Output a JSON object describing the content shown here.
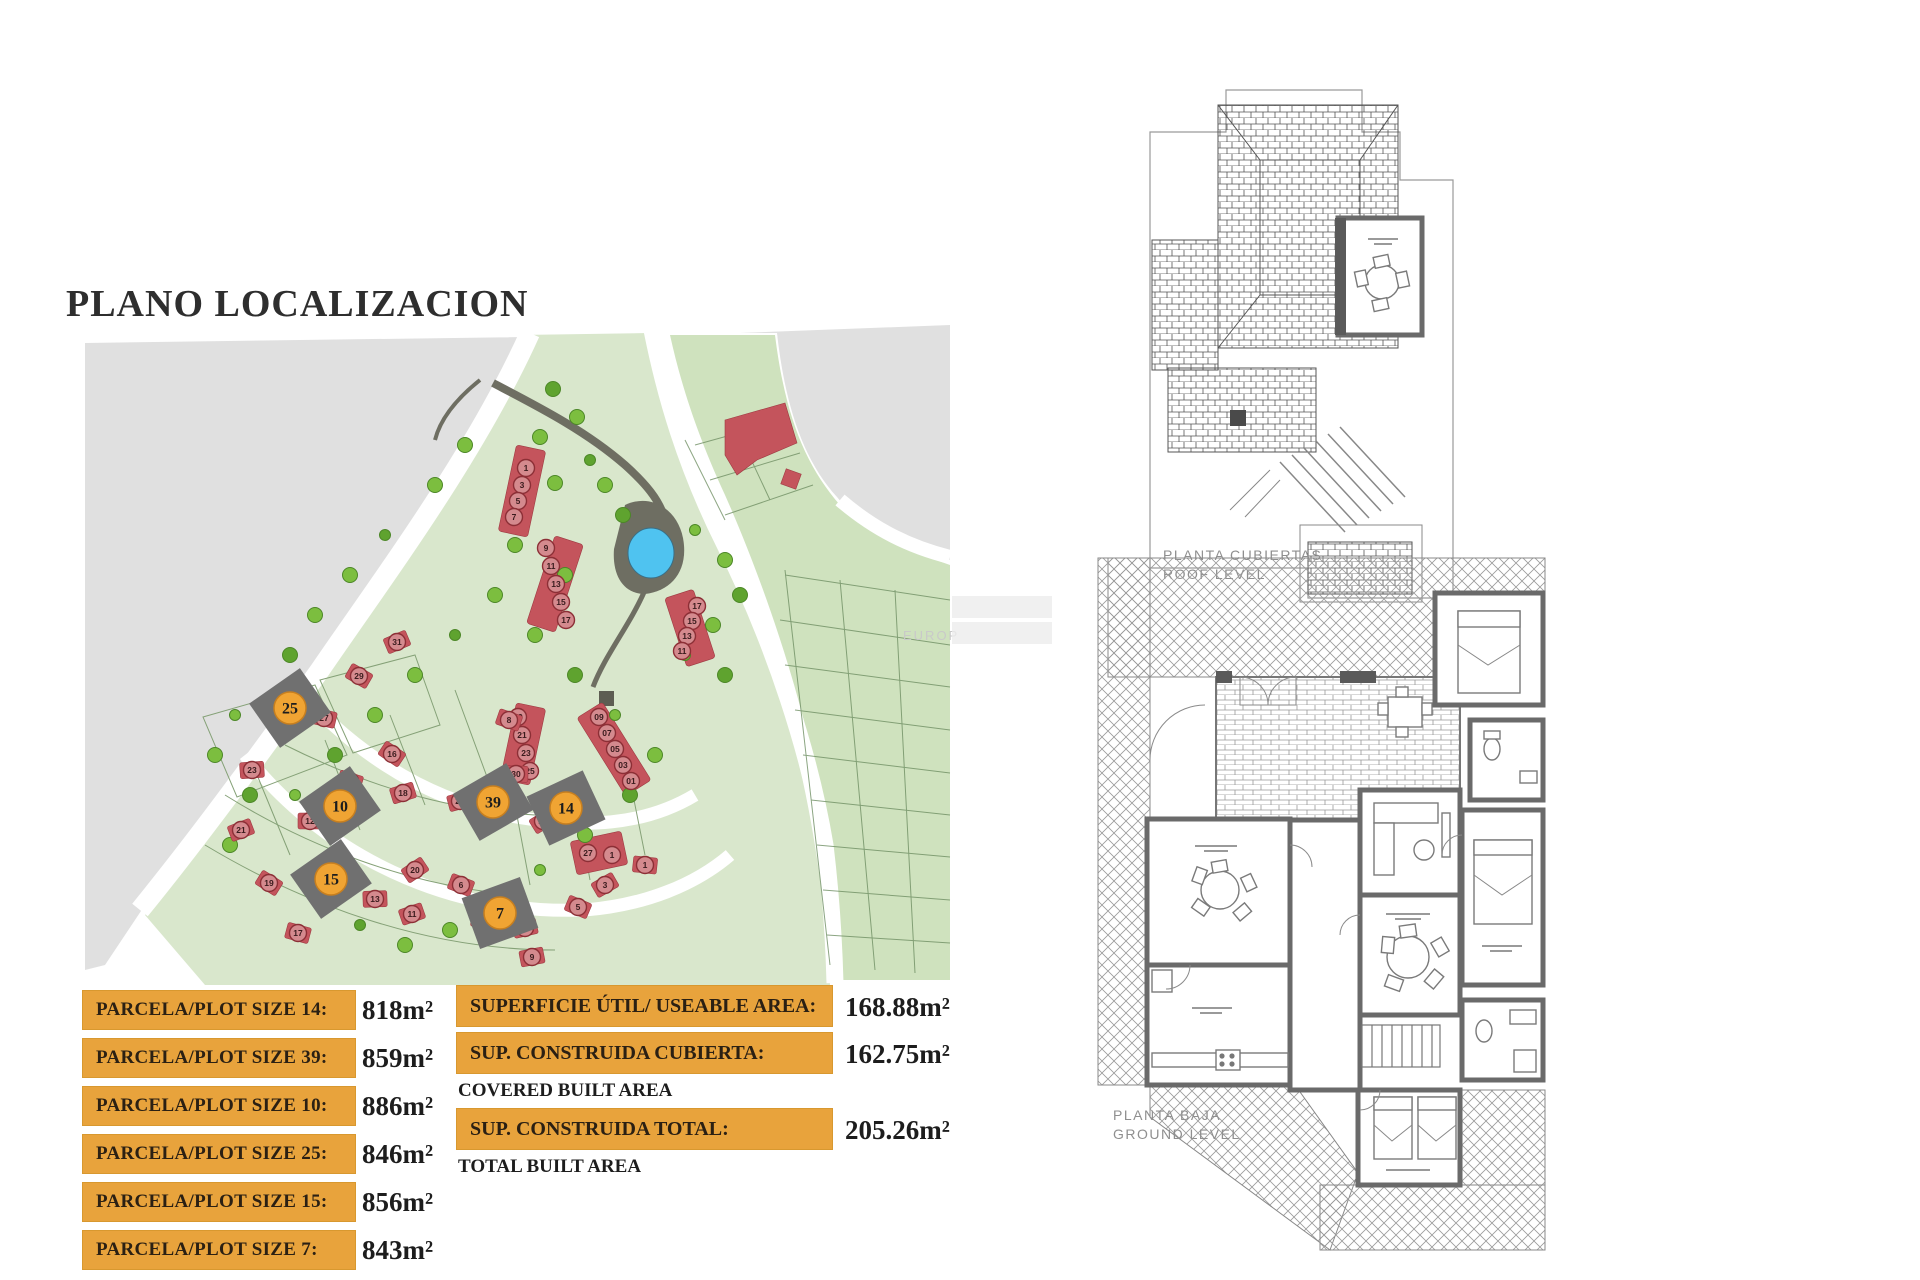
{
  "title": "PLANO LOCALIZACION",
  "watermark": "EUROP",
  "plot_table": {
    "rows": [
      {
        "label": "PARCELA/PLOT SIZE 14:",
        "value": "818m²"
      },
      {
        "label": "PARCELA/PLOT SIZE 39:",
        "value": "859m²"
      },
      {
        "label": "PARCELA/PLOT SIZE 10:",
        "value": "886m²"
      },
      {
        "label": "PARCELA/PLOT SIZE 25:",
        "value": "846m²"
      },
      {
        "label": "PARCELA/PLOT SIZE 15:",
        "value": "856m²"
      },
      {
        "label": "PARCELA/PLOT SIZE 7:",
        "value": "843m²"
      }
    ]
  },
  "area_table": {
    "rows": [
      {
        "label": "SUPERFICIE ÚTIL/ USEABLE AREA:",
        "sublabel": "",
        "value": "168.88m²"
      },
      {
        "label": "SUP. CONSTRUIDA CUBIERTA:",
        "sublabel": "COVERED BUILT AREA",
        "value": "162.75m²"
      },
      {
        "label": "SUP. CONSTRUIDA TOTAL:",
        "sublabel": "TOTAL BUILT AREA",
        "value": "205.26m²"
      }
    ]
  },
  "plans": {
    "roof": {
      "line1": "PLANTA CUBIERTAS",
      "line2": "ROOF LEVEL"
    },
    "ground": {
      "line1": "PLANTA BAJA",
      "line2": "GROUND LEVEL"
    }
  },
  "map": {
    "plot_markers": [
      {
        "n": "25",
        "x": 205,
        "y": 383,
        "r": -35
      },
      {
        "n": "10",
        "x": 255,
        "y": 481,
        "r": -35
      },
      {
        "n": "39",
        "x": 408,
        "y": 477,
        "r": -30
      },
      {
        "n": "14",
        "x": 481,
        "y": 483,
        "r": -25
      },
      {
        "n": "15",
        "x": 246,
        "y": 554,
        "r": -35
      },
      {
        "n": "7",
        "x": 415,
        "y": 588,
        "r": -20
      }
    ],
    "house_markers": [
      {
        "n": "1",
        "x": 441,
        "y": 143,
        "strip": true
      },
      {
        "n": "3",
        "x": 437,
        "y": 160,
        "strip": true
      },
      {
        "n": "5",
        "x": 433,
        "y": 176,
        "strip": true
      },
      {
        "n": "7",
        "x": 429,
        "y": 192,
        "strip": true
      },
      {
        "n": "9",
        "x": 461,
        "y": 223,
        "strip": true
      },
      {
        "n": "11",
        "x": 466,
        "y": 241,
        "strip": true
      },
      {
        "n": "13",
        "x": 471,
        "y": 259,
        "strip": true
      },
      {
        "n": "15",
        "x": 476,
        "y": 277,
        "strip": true
      },
      {
        "n": "17",
        "x": 481,
        "y": 295,
        "strip": true
      },
      {
        "n": "17",
        "x": 612,
        "y": 281,
        "strip": true
      },
      {
        "n": "15",
        "x": 607,
        "y": 296,
        "strip": true
      },
      {
        "n": "13",
        "x": 602,
        "y": 311,
        "strip": true
      },
      {
        "n": "11",
        "x": 597,
        "y": 326,
        "strip": true
      },
      {
        "n": "19",
        "x": 433,
        "y": 392,
        "strip": true
      },
      {
        "n": "21",
        "x": 437,
        "y": 410,
        "strip": true
      },
      {
        "n": "23",
        "x": 441,
        "y": 428,
        "strip": true
      },
      {
        "n": "25",
        "x": 445,
        "y": 446,
        "strip": true
      },
      {
        "n": "09",
        "x": 514,
        "y": 392,
        "strip": true
      },
      {
        "n": "07",
        "x": 522,
        "y": 408,
        "strip": true
      },
      {
        "n": "05",
        "x": 530,
        "y": 424,
        "strip": true
      },
      {
        "n": "03",
        "x": 538,
        "y": 440,
        "strip": true
      },
      {
        "n": "01",
        "x": 546,
        "y": 456,
        "strip": true
      },
      {
        "n": "27",
        "x": 503,
        "y": 528,
        "strip": true
      },
      {
        "n": "1",
        "x": 527,
        "y": 530,
        "strip": true
      },
      {
        "n": "31",
        "x": 312,
        "y": 317
      },
      {
        "n": "29",
        "x": 274,
        "y": 351
      },
      {
        "n": "27",
        "x": 239,
        "y": 393
      },
      {
        "n": "23",
        "x": 167,
        "y": 445
      },
      {
        "n": "21",
        "x": 156,
        "y": 505
      },
      {
        "n": "19",
        "x": 184,
        "y": 558
      },
      {
        "n": "17",
        "x": 213,
        "y": 608
      },
      {
        "n": "13",
        "x": 290,
        "y": 574
      },
      {
        "n": "11",
        "x": 327,
        "y": 589
      },
      {
        "n": "16",
        "x": 307,
        "y": 429
      },
      {
        "n": "14",
        "x": 265,
        "y": 456
      },
      {
        "n": "12",
        "x": 225,
        "y": 496
      },
      {
        "n": "18",
        "x": 318,
        "y": 468
      },
      {
        "n": "20",
        "x": 330,
        "y": 545
      },
      {
        "n": "8",
        "x": 424,
        "y": 395
      },
      {
        "n": "30",
        "x": 431,
        "y": 449
      },
      {
        "n": "27",
        "x": 375,
        "y": 476
      },
      {
        "n": "12",
        "x": 458,
        "y": 496
      },
      {
        "n": "6",
        "x": 376,
        "y": 560
      },
      {
        "n": "4",
        "x": 398,
        "y": 594
      },
      {
        "n": "2",
        "x": 440,
        "y": 603
      },
      {
        "n": "3",
        "x": 520,
        "y": 560
      },
      {
        "n": "5",
        "x": 493,
        "y": 582
      },
      {
        "n": "1",
        "x": 560,
        "y": 540
      },
      {
        "n": "9",
        "x": 447,
        "y": 632
      }
    ],
    "trees": [
      [
        468,
        64
      ],
      [
        492,
        92
      ],
      [
        455,
        112
      ],
      [
        505,
        135
      ],
      [
        470,
        158
      ],
      [
        520,
        160
      ],
      [
        538,
        190
      ],
      [
        610,
        205
      ],
      [
        640,
        235
      ],
      [
        655,
        270
      ],
      [
        628,
        300
      ],
      [
        600,
        330
      ],
      [
        640,
        350
      ],
      [
        380,
        120
      ],
      [
        350,
        160
      ],
      [
        300,
        210
      ],
      [
        265,
        250
      ],
      [
        230,
        290
      ],
      [
        205,
        330
      ],
      [
        150,
        390
      ],
      [
        130,
        430
      ],
      [
        165,
        470
      ],
      [
        145,
        520
      ],
      [
        210,
        470
      ],
      [
        250,
        430
      ],
      [
        290,
        390
      ],
      [
        330,
        350
      ],
      [
        370,
        310
      ],
      [
        410,
        270
      ],
      [
        450,
        310
      ],
      [
        490,
        350
      ],
      [
        530,
        390
      ],
      [
        570,
        430
      ],
      [
        545,
        470
      ],
      [
        500,
        510
      ],
      [
        455,
        545
      ],
      [
        410,
        575
      ],
      [
        365,
        605
      ],
      [
        320,
        620
      ],
      [
        275,
        600
      ],
      [
        480,
        250
      ],
      [
        430,
        220
      ]
    ]
  },
  "colors": {
    "table_orange": "#E8A33C",
    "map_green": "#D9E7CC",
    "map_green2": "#CFE2BE",
    "backdrop_gray": "#E0E0E0",
    "house_red": "#C4545C",
    "tree_green": "#7CBE3F",
    "tree_green_dark": "#5FA32F",
    "pond_blue": "#4FC3F0",
    "plot_gray": "#707070",
    "marker_orange": "#F0A433",
    "plan_gray": "#6a6a6a"
  }
}
